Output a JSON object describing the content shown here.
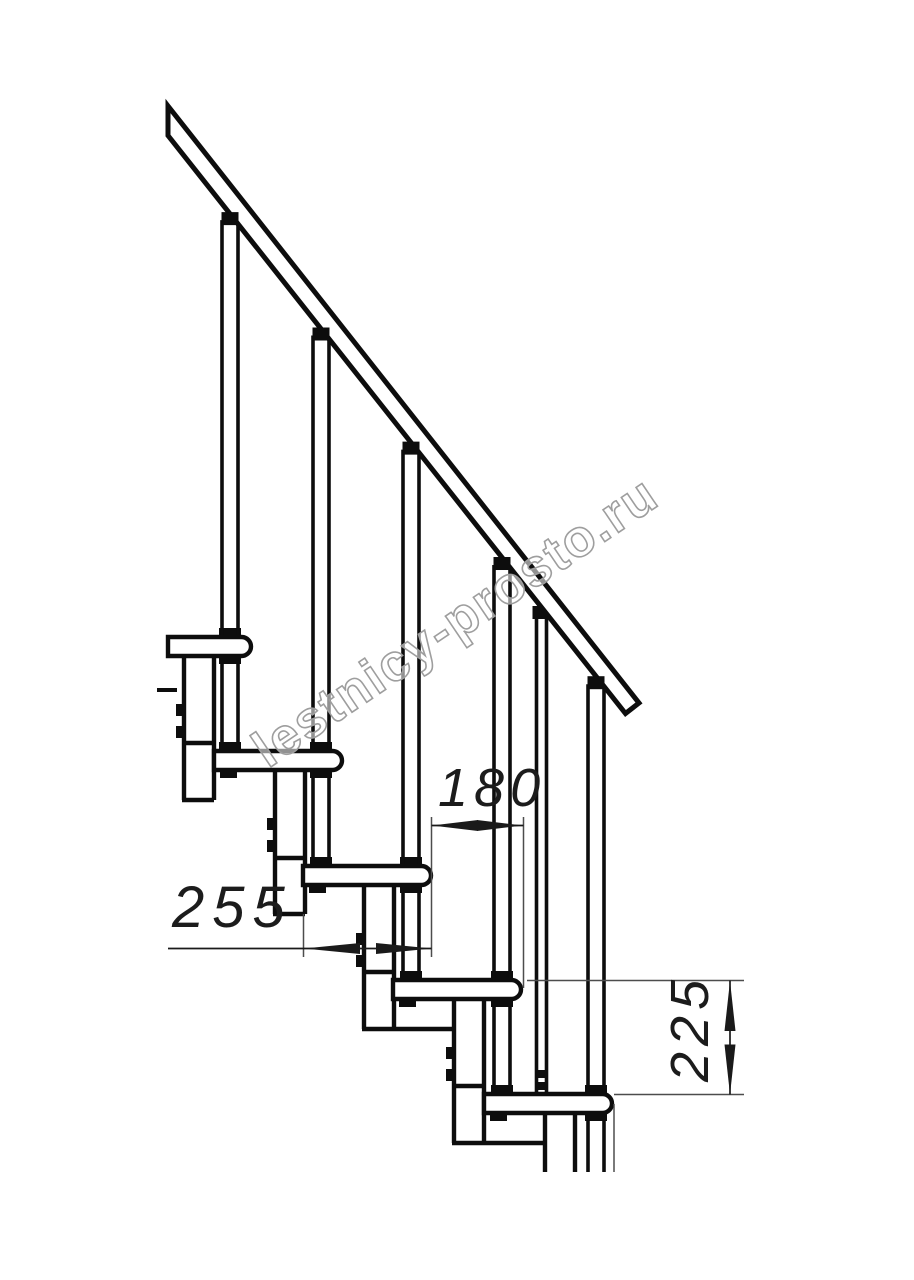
{
  "drawing": {
    "kind": "staircase-side-view-technical-drawing",
    "treads_visible": 5,
    "balusters_visible": 5
  },
  "dimensions": {
    "tread_depth": {
      "label": "255",
      "orientation": "horizontal"
    },
    "step_run": {
      "label": "180",
      "orientation": "horizontal"
    },
    "step_rise": {
      "label": "225",
      "orientation": "vertical"
    }
  },
  "watermark": {
    "text": "lestnicy-prosto.ru"
  },
  "colors": {
    "line": "#0d0d0d",
    "dimension_line": "#1a1a1a",
    "extension_line": "#4d4d4d",
    "watermark_stroke": "#9e9e9e",
    "background": "#ffffff"
  }
}
